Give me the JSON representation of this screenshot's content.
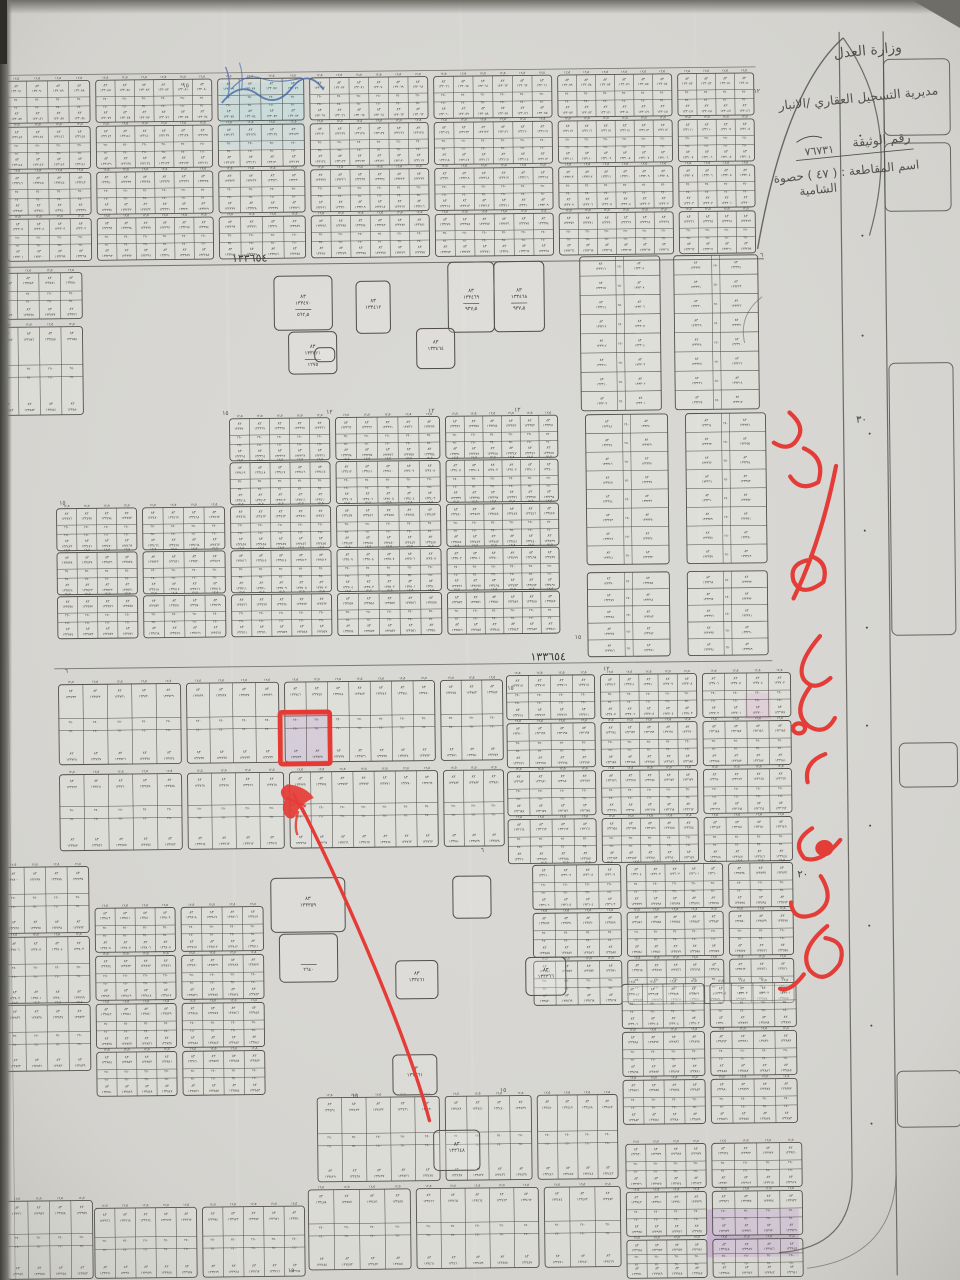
{
  "meta": {
    "description": "Photograph of a cadastral subdivision map (land plot registry plan), district 47 Haswat al-Shamiya, with red marker annotations marking one plot",
    "paper_color": "#d8d7d3",
    "ink_color": "#34332e",
    "line_color": "#4a4843"
  },
  "stamp": {
    "line1": "وزارة العدل",
    "line2": "مديرية التسجيل العقاري /الانبار",
    "doc_label": "رقم الوثيقة",
    "doc_number": "٧٦٧٣١",
    "district_line": "اسم المقاطعة : ( ٤٧ ) حصوة",
    "district_line2": "الشامية"
  },
  "street_labels": [
    {
      "text": "١٣٣٦٥٤",
      "x": 254,
      "y": 259
    },
    {
      "text": "١٣٣٦٥٤",
      "x": 548,
      "y": 661
    }
  ],
  "road_labels": [
    {
      "text": "٣٠",
      "x": 864,
      "y": 427,
      "size": 10
    },
    {
      "text": "٢٠",
      "x": 800,
      "y": 881,
      "size": 10
    }
  ],
  "small_numbers": [
    {
      "text": "١٥",
      "x": 192,
      "y": 84
    },
    {
      "text": "١٢",
      "x": 763,
      "y": 96
    },
    {
      "text": "٦",
      "x": 766,
      "y": 260
    },
    {
      "text": "١٢",
      "x": 520,
      "y": 412
    },
    {
      "text": "١٢",
      "x": 434,
      "y": 412
    },
    {
      "text": "١٢",
      "x": 332,
      "y": 412
    },
    {
      "text": "١٥",
      "x": 228,
      "y": 412
    },
    {
      "text": "١٥",
      "x": 64,
      "y": 500
    },
    {
      "text": "١٥",
      "x": 578,
      "y": 640
    },
    {
      "text": "٦",
      "x": 66,
      "y": 668
    },
    {
      "text": "١٥",
      "x": 510,
      "y": 690
    },
    {
      "text": "١٢",
      "x": 606,
      "y": 672
    },
    {
      "text": "٦",
      "x": 480,
      "y": 852
    },
    {
      "text": "١٥",
      "x": 350,
      "y": 1096
    },
    {
      "text": "١٥",
      "x": 498,
      "y": 1092
    },
    {
      "text": "١٥",
      "x": 284,
      "y": 1270
    }
  ],
  "cell": {
    "width": "١٢٫٥",
    "block": "٨٣",
    "area": "٢٥٠"
  },
  "strips": [
    [
      12,
      76,
      84,
      42,
      4,
      133091
    ],
    [
      102,
      76,
      116,
      42,
      6,
      133085
    ],
    [
      224,
      76,
      86,
      42,
      4,
      133079
    ],
    [
      316,
      76,
      118,
      42,
      6,
      133073
    ],
    [
      440,
      76,
      118,
      42,
      6,
      133066
    ],
    [
      564,
      76,
      114,
      42,
      6,
      133059
    ],
    [
      684,
      76,
      76,
      42,
      4,
      133053
    ],
    [
      12,
      122,
      84,
      42,
      4,
      133148
    ],
    [
      102,
      122,
      116,
      42,
      6,
      133142
    ],
    [
      224,
      122,
      86,
      42,
      4,
      133136
    ],
    [
      316,
      122,
      118,
      42,
      6,
      133130
    ],
    [
      440,
      122,
      118,
      42,
      6,
      133124
    ],
    [
      564,
      122,
      114,
      42,
      6,
      133117
    ],
    [
      684,
      122,
      76,
      42,
      4,
      133111
    ],
    [
      12,
      168,
      84,
      42,
      4,
      133246
    ],
    [
      102,
      168,
      116,
      42,
      6,
      133240
    ],
    [
      224,
      168,
      86,
      42,
      4,
      133233
    ],
    [
      316,
      168,
      118,
      42,
      6,
      133227
    ],
    [
      440,
      168,
      118,
      42,
      6,
      133220
    ],
    [
      564,
      168,
      114,
      42,
      6,
      133213
    ],
    [
      684,
      168,
      76,
      42,
      4,
      133207
    ],
    [
      12,
      214,
      84,
      42,
      4,
      133305
    ],
    [
      102,
      214,
      116,
      42,
      6,
      133299
    ],
    [
      224,
      214,
      86,
      42,
      4,
      133292
    ],
    [
      316,
      214,
      118,
      42,
      6,
      133286
    ],
    [
      440,
      214,
      118,
      42,
      6,
      133279
    ],
    [
      564,
      214,
      114,
      42,
      6,
      133272
    ],
    [
      684,
      214,
      76,
      42,
      4,
      133266
    ],
    [
      0,
      268,
      86,
      46,
      4,
      133583
    ],
    [
      0,
      322,
      86,
      88,
      4,
      133587
    ],
    [
      232,
      416,
      100,
      42,
      5,
      133370
    ],
    [
      338,
      416,
      104,
      42,
      5,
      133363
    ],
    [
      448,
      416,
      112,
      42,
      6,
      133356
    ],
    [
      232,
      460,
      100,
      42,
      5,
      133419
    ],
    [
      338,
      460,
      104,
      42,
      5,
      133412
    ],
    [
      448,
      460,
      112,
      42,
      6,
      133405
    ],
    [
      58,
      504,
      80,
      42,
      4,
      133476
    ],
    [
      144,
      504,
      82,
      42,
      4,
      133470
    ],
    [
      232,
      504,
      100,
      42,
      5,
      133464
    ],
    [
      338,
      504,
      104,
      42,
      5,
      133457
    ],
    [
      448,
      504,
      112,
      42,
      6,
      133450
    ],
    [
      58,
      548,
      80,
      42,
      4,
      133528
    ],
    [
      144,
      548,
      82,
      42,
      4,
      133522
    ],
    [
      232,
      548,
      100,
      42,
      5,
      133516
    ],
    [
      338,
      548,
      104,
      42,
      5,
      133509
    ],
    [
      448,
      548,
      112,
      42,
      6,
      133502
    ],
    [
      58,
      592,
      80,
      42,
      4,
      133578
    ],
    [
      144,
      592,
      82,
      42,
      4,
      133572
    ],
    [
      232,
      592,
      100,
      42,
      5,
      133566
    ],
    [
      338,
      592,
      104,
      42,
      5,
      133559
    ],
    [
      448,
      592,
      112,
      42,
      6,
      133552
    ],
    [
      58,
      680,
      122,
      80,
      5,
      133733
    ],
    [
      186,
      680,
      92,
      80,
      4,
      133739
    ],
    [
      284,
      680,
      150,
      80,
      7,
      133746
    ],
    [
      440,
      680,
      62,
      80,
      3,
      133754
    ],
    [
      58,
      770,
      122,
      76,
      5,
      133762
    ],
    [
      186,
      770,
      96,
      76,
      4,
      133768
    ],
    [
      288,
      770,
      148,
      76,
      7,
      133775
    ],
    [
      442,
      770,
      60,
      76,
      3,
      133783
    ],
    [
      506,
      676,
      88,
      44,
      4,
      133718
    ],
    [
      600,
      676,
      96,
      44,
      5,
      133712
    ],
    [
      702,
      676,
      88,
      44,
      4,
      133706
    ],
    [
      506,
      724,
      88,
      44,
      4,
      133700
    ],
    [
      600,
      724,
      96,
      44,
      5,
      133694
    ],
    [
      702,
      724,
      88,
      44,
      4,
      133688
    ],
    [
      506,
      772,
      88,
      44,
      4,
      133682
    ],
    [
      600,
      772,
      96,
      44,
      5,
      133676
    ],
    [
      702,
      772,
      88,
      44,
      4,
      133670
    ],
    [
      506,
      820,
      88,
      44,
      4,
      133664
    ],
    [
      600,
      820,
      96,
      44,
      5,
      133658
    ],
    [
      702,
      820,
      88,
      44,
      4,
      133652
    ],
    [
      0,
      862,
      86,
      66,
      4,
      133800
    ],
    [
      0,
      932,
      86,
      66,
      4,
      133806
    ],
    [
      92,
      904,
      80,
      44,
      4,
      133812
    ],
    [
      178,
      904,
      82,
      44,
      4,
      133818
    ],
    [
      92,
      952,
      80,
      44,
      4,
      133824
    ],
    [
      178,
      952,
      82,
      44,
      4,
      133830
    ],
    [
      530,
      866,
      88,
      44,
      4,
      133610
    ],
    [
      624,
      866,
      96,
      44,
      5,
      133604
    ],
    [
      726,
      866,
      64,
      44,
      3,
      133598
    ],
    [
      530,
      914,
      88,
      44,
      4,
      133592
    ],
    [
      624,
      914,
      96,
      44,
      5,
      133586
    ],
    [
      726,
      914,
      64,
      44,
      3,
      133580
    ],
    [
      530,
      962,
      88,
      44,
      4,
      133574
    ],
    [
      624,
      962,
      96,
      44,
      5,
      133568
    ],
    [
      726,
      962,
      64,
      44,
      3,
      133562
    ],
    [
      0,
      1000,
      86,
      66,
      4,
      133836
    ],
    [
      92,
      1000,
      80,
      44,
      4,
      133842
    ],
    [
      178,
      1000,
      82,
      44,
      4,
      133848
    ],
    [
      92,
      1048,
      80,
      44,
      4,
      133854
    ],
    [
      178,
      1048,
      82,
      44,
      4,
      133860
    ],
    [
      618,
      986,
      82,
      44,
      4,
      133910
    ],
    [
      706,
      986,
      86,
      44,
      4,
      133904
    ],
    [
      618,
      1034,
      82,
      44,
      4,
      133898
    ],
    [
      706,
      1034,
      86,
      44,
      4,
      133892
    ],
    [
      618,
      1082,
      82,
      44,
      4,
      133886
    ],
    [
      706,
      1082,
      86,
      44,
      4,
      133880
    ],
    [
      312,
      1096,
      122,
      84,
      5,
      133434
    ],
    [
      440,
      1096,
      86,
      84,
      4,
      133442
    ],
    [
      532,
      1096,
      80,
      84,
      4,
      133450
    ],
    [
      302,
      1188,
      102,
      80,
      4,
      133458
    ],
    [
      410,
      1188,
      122,
      80,
      5,
      133466
    ],
    [
      538,
      1188,
      76,
      80,
      3,
      133474
    ],
    [
      620,
      1146,
      80,
      44,
      4,
      133930
    ],
    [
      706,
      1146,
      90,
      44,
      4,
      133924
    ],
    [
      620,
      1194,
      80,
      44,
      4,
      133942
    ],
    [
      706,
      1194,
      90,
      44,
      4,
      133936
    ],
    [
      620,
      1242,
      80,
      38,
      4,
      133954
    ],
    [
      706,
      1242,
      90,
      38,
      4,
      133948
    ],
    [
      0,
      1196,
      86,
      78,
      4,
      133960
    ],
    [
      88,
      1204,
      102,
      70,
      5,
      133966
    ],
    [
      196,
      1204,
      102,
      70,
      5,
      133974
    ]
  ],
  "vstrips": [
    [
      584,
      258,
      80,
      154,
      8,
      133316
    ],
    [
      678,
      258,
      84,
      154,
      8,
      133332
    ],
    [
      588,
      416,
      82,
      150,
      8,
      133348
    ],
    [
      688,
      416,
      80,
      150,
      8,
      133364
    ],
    [
      588,
      574,
      82,
      84,
      5,
      133390
    ],
    [
      688,
      574,
      80,
      84,
      5,
      133398
    ]
  ],
  "big_plots": [
    [
      278,
      274,
      58,
      54,
      "١٣٣٤٧٠",
      "٥٦٢٫٥"
    ],
    [
      452,
      262,
      46,
      70,
      "١٣٣٤٦٩",
      "٩٣٧٫٥"
    ],
    [
      498,
      262,
      50,
      70,
      "١٣٣٤٦٨",
      "٩٣٧٫٥"
    ],
    [
      292,
      330,
      48,
      42,
      "١٣٣٤٧١",
      "١٢٧٥"
    ],
    [
      420,
      328,
      38,
      40,
      "١٣٣٤٦٤",
      ""
    ],
    [
      360,
      280,
      34,
      52,
      "١٣٣٤١٢",
      ""
    ],
    [
      318,
      346,
      20,
      14,
      "",
      ""
    ],
    [
      268,
      876,
      74,
      54,
      "١٣٣٣٥٩",
      ""
    ],
    [
      276,
      932,
      58,
      48,
      "",
      "٢٦٤٠"
    ],
    [
      392,
      960,
      42,
      38,
      "١٣٣٤٦١",
      ""
    ],
    [
      450,
      876,
      38,
      42,
      "",
      ""
    ],
    [
      522,
      958,
      40,
      38,
      "١٣٣٣٦٦",
      ""
    ],
    [
      388,
      1054,
      44,
      40,
      "١٣٣٦٦١",
      ""
    ],
    [
      428,
      1130,
      46,
      40,
      "١٣٣٦٤٨",
      ""
    ]
  ],
  "roadside_blocks": [
    [
      890,
      64,
      66,
      76
    ],
    [
      890,
      148,
      66,
      68
    ],
    [
      892,
      368,
      64,
      272
    ],
    [
      898,
      748,
      58,
      44
    ],
    [
      892,
      1076,
      64,
      56
    ]
  ],
  "highlights": [
    {
      "x": 226,
      "y": 80,
      "w": 84,
      "h": 38,
      "color": "#8fd2da",
      "opacity": 0.5,
      "kind": "blue-highlighter"
    },
    {
      "x": 226,
      "y": 118,
      "w": 84,
      "h": 28,
      "color": "#8fd2da",
      "opacity": 0.3,
      "kind": "blue-highlighter"
    },
    {
      "x": 285,
      "y": 712,
      "w": 44,
      "h": 48,
      "color": "#b99ed0",
      "opacity": 0.55,
      "kind": "purple-highlighter-marked-plot"
    },
    {
      "x": 744,
      "y": 696,
      "w": 26,
      "h": 26,
      "color": "#d9a8cc",
      "opacity": 0.5,
      "kind": "pink-highlighter"
    },
    {
      "x": 700,
      "y": 1212,
      "w": 92,
      "h": 48,
      "color": "#bf93d2",
      "opacity": 0.55,
      "kind": "purple-highlighter"
    }
  ],
  "red_annotation": {
    "color": "#e6332e",
    "rect": {
      "x": 279,
      "y": 710,
      "w": 50,
      "h": 52
    },
    "arrow_from": [
      424,
      1120
    ],
    "arrow_to": [
      300,
      806
    ],
    "note_transcription": "كتابة يدوية بقلم أحمر على طول الشارع (غير واضحة)"
  },
  "pen_marks": {
    "blue_pen": "#3a5fa8",
    "dark_pen": "#4a4a46"
  }
}
